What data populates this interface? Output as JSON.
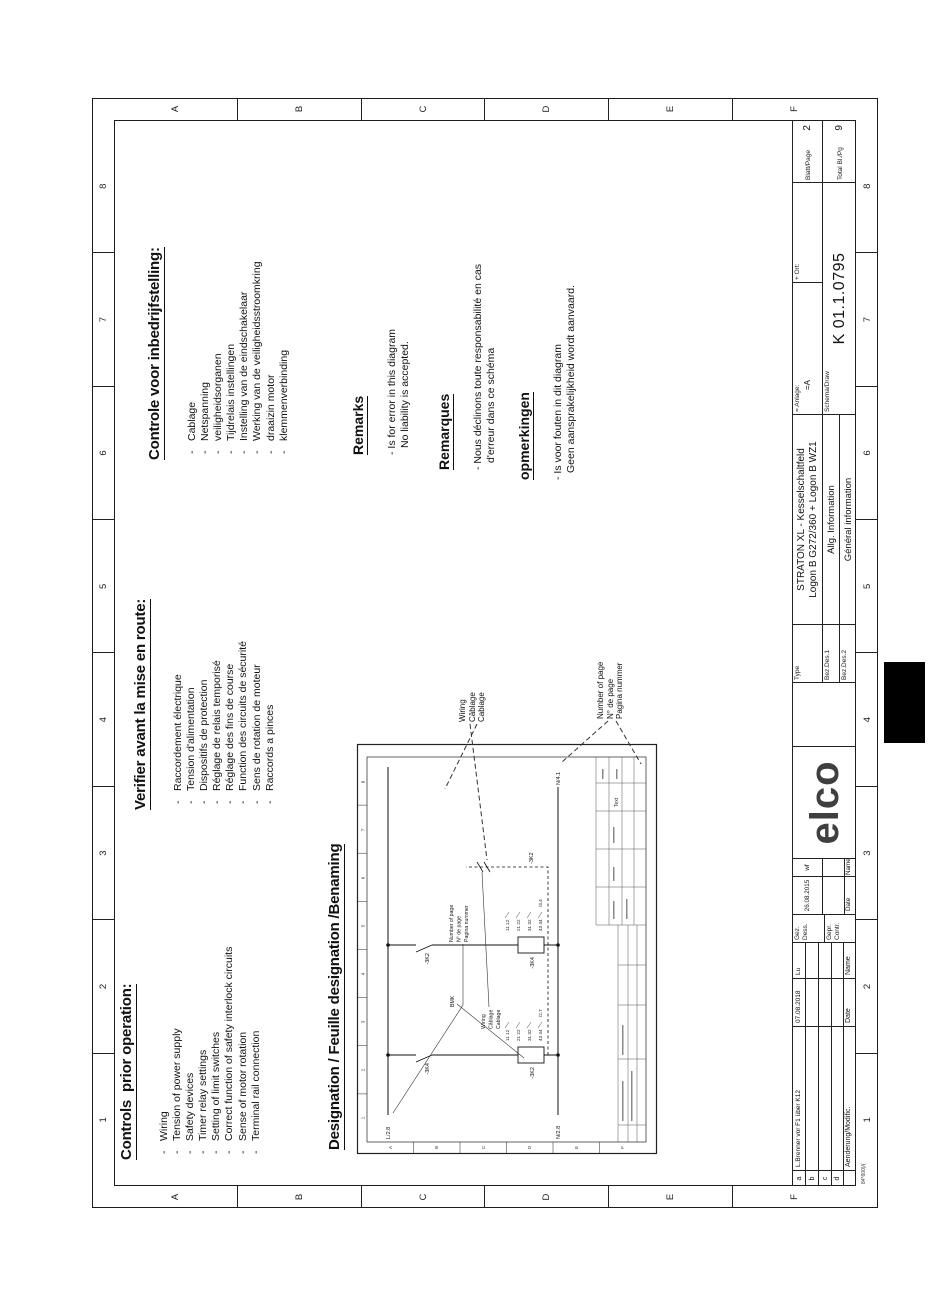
{
  "page": {
    "ruler_columns": [
      "1",
      "2",
      "3",
      "4",
      "5",
      "6",
      "7",
      "8"
    ],
    "ruler_rows": [
      "A",
      "B",
      "C",
      "D",
      "E",
      "F"
    ]
  },
  "sections": {
    "en": {
      "heading": "Controls  prior operation:",
      "items": [
        "Wiring",
        "Tension of power supply",
        "Safety devices",
        "Timer relay settings",
        "Setting of limit switches",
        "Correct function of safety interlock circuits",
        "Sense of motor rotation",
        "Terminal rail connection"
      ]
    },
    "fr": {
      "heading": "Verifier avant la mise en route:",
      "items": [
        "Raccordement électrique",
        "Tension d'alimentation",
        "Dispositifs de protection",
        "Réglage de relais temporisé",
        "Réglage des fins de course",
        "Function des circuits de sécurité",
        "Sens de rotation de moteur",
        "Raccords a pinces"
      ]
    },
    "nl": {
      "heading": "Controle voor inbedrijfstelling:",
      "items": [
        "Cablage",
        "Netspanning",
        "veiligheidsorganen",
        "Tijdrelais instellingen",
        "Instelling van de eindschakelaar",
        "Werking van de veiligheidsstroomkring",
        "draaizin motor",
        "klemmenverbinding"
      ]
    },
    "remarks_en": {
      "heading": "Remarks",
      "lines": [
        "- Is for error in this diagram",
        "No liability is accepted."
      ]
    },
    "remarks_fr": {
      "heading": "Remarques",
      "lines": [
        "- Nous déclinons toute responsabilité en cas",
        "d'erreur dans ce schéma"
      ]
    },
    "remarks_nl": {
      "heading": "opmerkingen",
      "lines": [
        "- Is voor fouten in dit diagram",
        "Geen aansprakelijkheid wordt aanvaard."
      ]
    },
    "designation_heading": "Designation / Feuille designation /Benaming"
  },
  "callouts": {
    "wiring": [
      "Wiring",
      "Câblage",
      "Cablage"
    ],
    "number_of_page": [
      "Number of page",
      "N° de page",
      "Pagina nummer"
    ]
  },
  "diagram": {
    "rail_l": "L/2.8",
    "rail_n_left": "N/2.8",
    "rail_n_right": "N/4.1",
    "branch1": {
      "contact": "-3K4",
      "coil": "-3K2",
      "pins": [
        "11 12",
        "21 22",
        "31 32",
        "43 44"
      ],
      "ref": "/2.7"
    },
    "branch2": {
      "contact": "-3K2",
      "coil": "-3K4",
      "pins": [
        "11 12",
        "21 22",
        "31 32",
        "43 44"
      ],
      "ref": "/3.4"
    },
    "wire_ref": "-3K2",
    "labels": {
      "bmk": "BMK",
      "number_of_page": [
        "Number of page",
        "N° de page",
        "Pagina nummer"
      ],
      "wiring": [
        "Wiring",
        "Câblage",
        "Cablage"
      ]
    },
    "titleblock_text": "Text"
  },
  "titleblock": {
    "revision": {
      "row_markers": [
        "a",
        "b",
        "c",
        "d"
      ],
      "entry": {
        "description": "L.Brenner vor F1 über K12",
        "date": "07.08.2018",
        "name": "Lu"
      },
      "footer": {
        "description": "Aenderung/Modific.",
        "date": "Date",
        "name": "Name"
      },
      "form_number": "84*600)/("
    },
    "approval": {
      "drawn_label1": "Gez.",
      "drawn_label2": "Dess.",
      "checked_label1": "Gepr.",
      "checked_label2": "Contr.",
      "date": "26.08.2015",
      "name": "wf",
      "date_label": "Date",
      "name_label": "Name"
    },
    "logo": "elco",
    "type": {
      "label": "Type",
      "line1": "STRATON XL - Kesselschaltfeld",
      "line2": "Logon B G272/360 + Logon B WZ1",
      "bez1_label": "Bez.Des.1",
      "bez1": "Allg. Information",
      "bez2_label": "Bez.Des.2",
      "bez2": "Général information"
    },
    "location": {
      "anlage_label": "= Anlage:",
      "anlage_value": "=A",
      "ort_label": "+ Ort:",
      "schema_label": "Schema/Draw",
      "schema_value": "K 01.1.0795"
    },
    "pages": {
      "blatt_label": "Blatt/Page",
      "blatt_value": "2",
      "total_label": "Total Bl./Pg",
      "total_value": "9"
    }
  }
}
